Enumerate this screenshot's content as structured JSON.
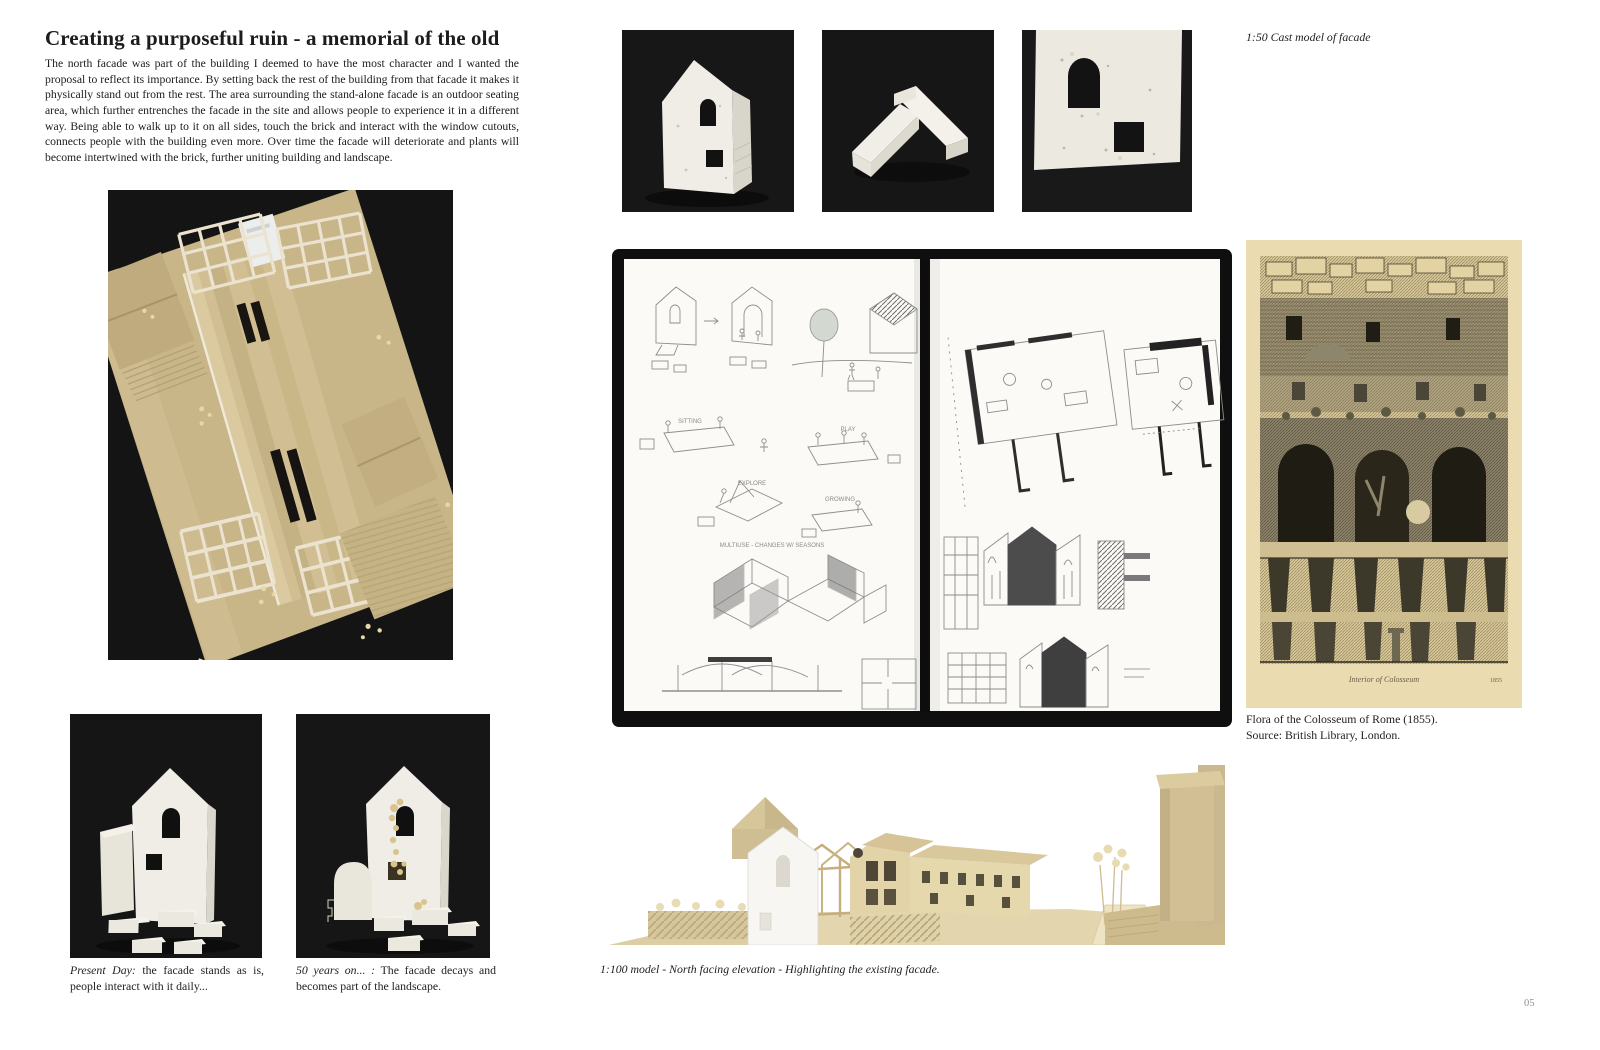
{
  "article": {
    "title": "Creating a purposeful ruin - a memorial of the old",
    "body": "The north facade was part of the building I deemed to have the most character and I wanted the proposal to reflect its importance. By setting back the rest of the building from that facade it makes it physically stand out from the rest. The area surrounding the stand-alone facade is an outdoor seating area, which further entrenches the facade in the site and allows people to experience it in a different way. Being able to walk up to it on all sides, touch the brick and interact with the window cutouts, connects people with the building even more. Over time the facade will deteriorate and plants will become intertwined with the brick, further uniting building and landscape."
  },
  "captions": {
    "cast_model": "1:50 Cast model of facade",
    "present_day_label": "Present Day:",
    "present_day_text": " the facade stands as is, people interact with it daily...",
    "fifty_years_label": "50 years on... :",
    "fifty_years_text": " The facade decays and becomes part of the landscape.",
    "colosseum_line1": "Flora of the Colosseum of Rome (1855).",
    "colosseum_line2": "Source: British Library, London.",
    "bottom_model": "1:100 model - North facing elevation - Highlighting the existing facade."
  },
  "etching": {
    "caption": "Interior of Colosseum",
    "year": "1855"
  },
  "sketch_labels": {
    "sitting": "SITTING",
    "play": "PLAY",
    "explore": "EXPLORE",
    "growing": "GROWING",
    "multiuse": "MULTIUSE - CHANGES W/ SEASONS"
  },
  "colors": {
    "cardboard": "#c8b588",
    "cast_white": "#efede5",
    "photo_background": "#151515",
    "etching_paper": "#eadbb0"
  },
  "page": {
    "number": "05"
  }
}
